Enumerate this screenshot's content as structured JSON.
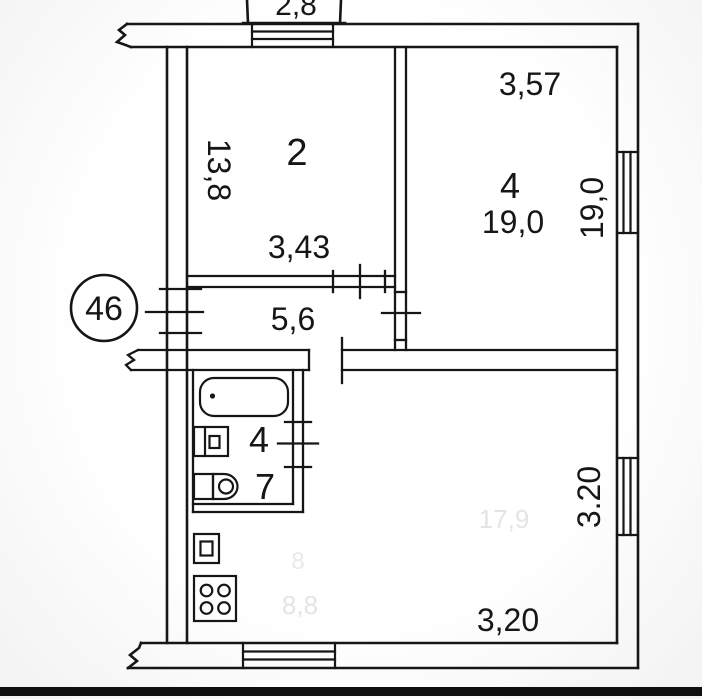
{
  "plan": {
    "badge": "46",
    "balcony": {
      "area": "2,8"
    },
    "room2": {
      "number": "2",
      "depth": "13,8",
      "width": "3,43"
    },
    "room4": {
      "number": "4",
      "area": "19,0",
      "width": "3,57",
      "side": "19,0"
    },
    "hallway": {
      "area": "5,6"
    },
    "bathroom": {
      "sink": "4",
      "toilet": "7"
    },
    "living": {
      "width": "3,20",
      "side": "3.20",
      "ghost": "17,9"
    },
    "kitchen": {
      "ghost_small": "8",
      "ghost": "8,8"
    }
  },
  "colors": {
    "line": "#161616",
    "background": "#fafafa",
    "ghost_text": "#e4e4e4",
    "bottom_bar": "#0f0f0f"
  }
}
